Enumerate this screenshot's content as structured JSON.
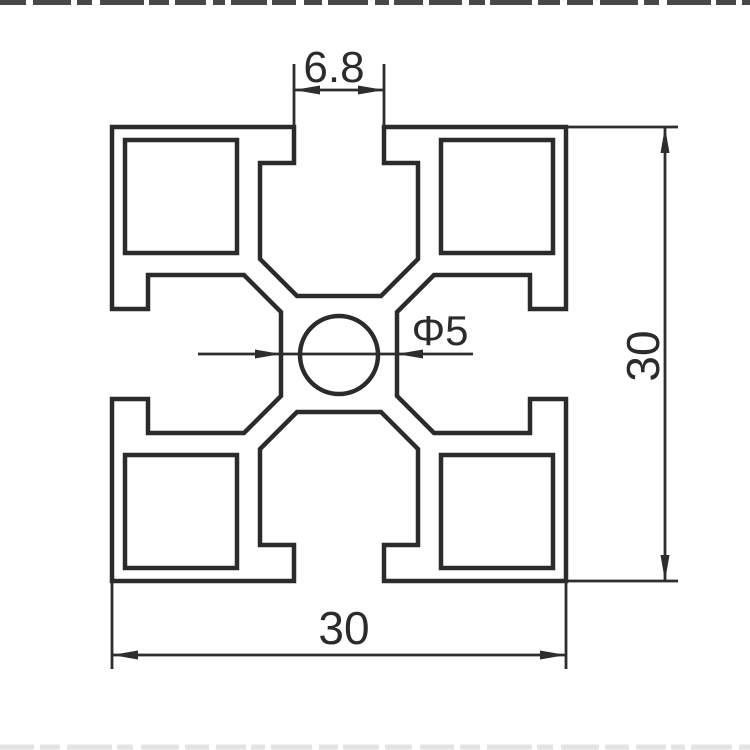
{
  "drawing": {
    "labels": {
      "slot_opening": "6.8",
      "hole_diameter": "Φ5",
      "overall_height": "30",
      "overall_width": "30"
    },
    "colors": {
      "line": "#2b2b2b",
      "background": "#ffffff",
      "top_crop_artifact": "#484848",
      "bottom_crop_artifact": "#e3e3e3"
    }
  }
}
